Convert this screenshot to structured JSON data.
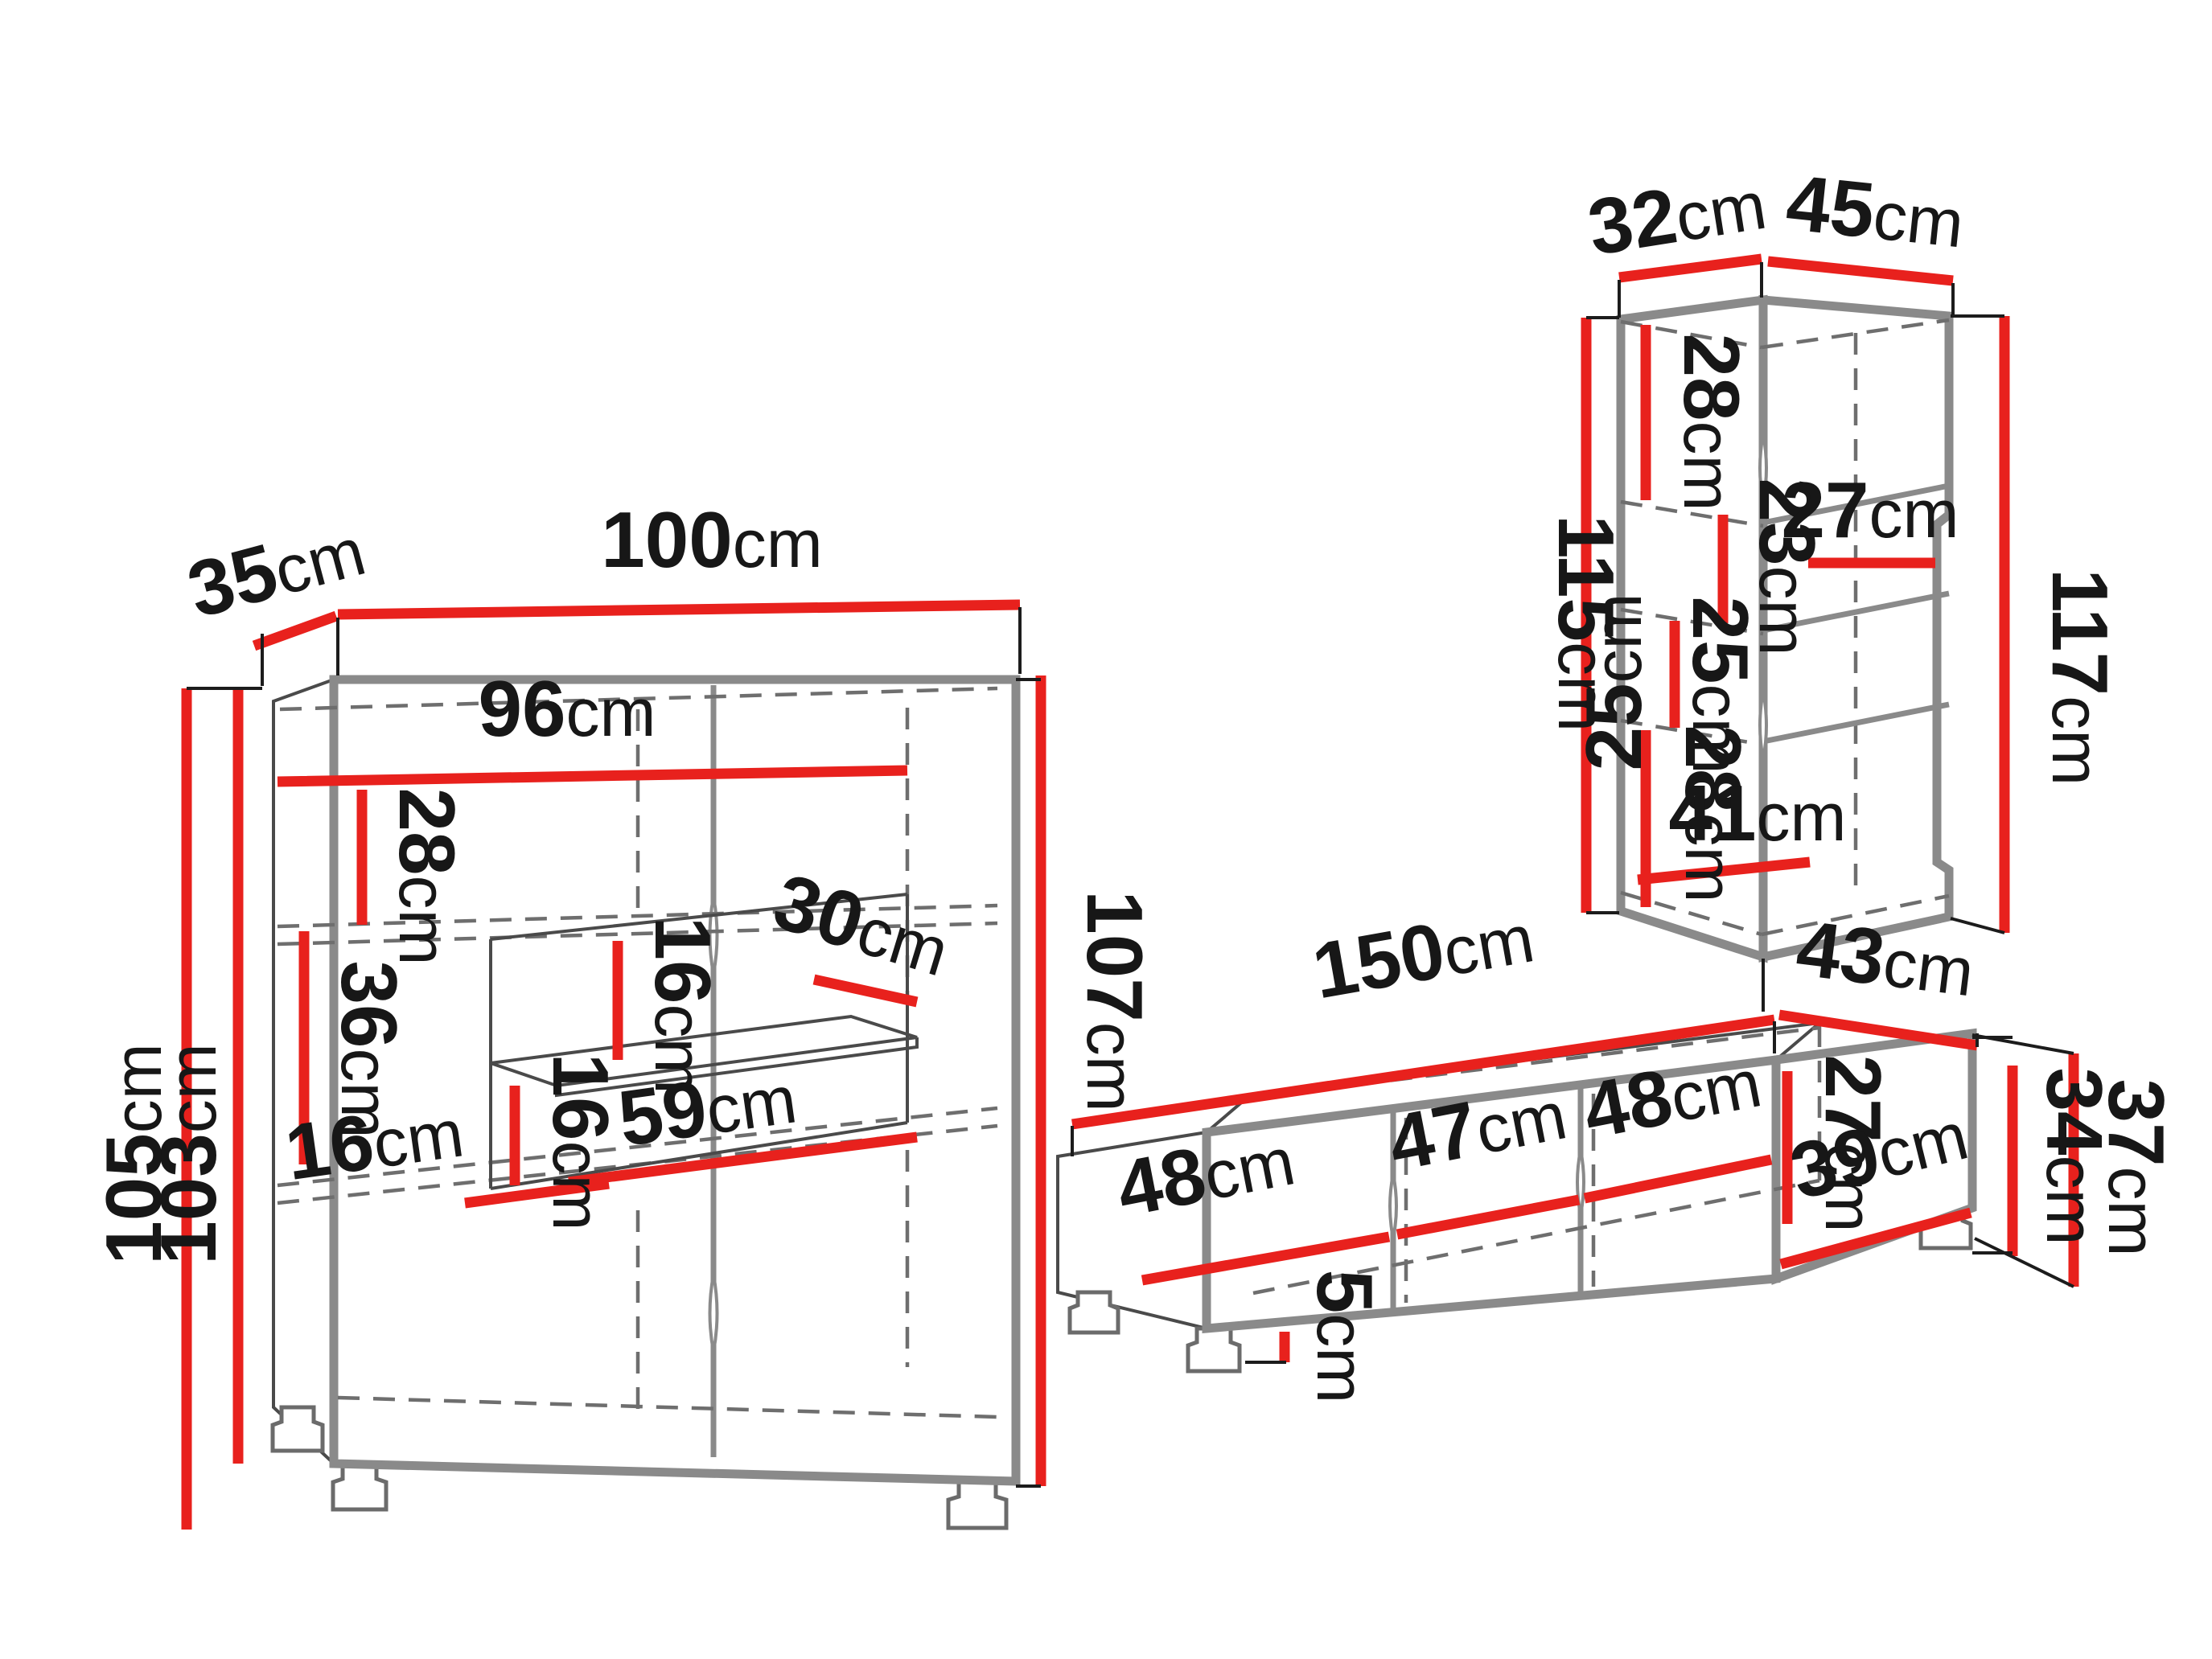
{
  "diagram_title": "furniture-set-dimension-diagram",
  "unit": "cm",
  "colors": {
    "dimension_red": "#e8211d",
    "carcass_gray": "#8a8a8a",
    "label_black": "#171717",
    "background": "#ffffff"
  },
  "highboard": {
    "depth_top": {
      "n": "35",
      "u": "cm"
    },
    "width_top": {
      "n": "100",
      "u": "cm"
    },
    "inner_width": {
      "n": "96",
      "u": "cm"
    },
    "top_section": {
      "n": "28",
      "u": "cm"
    },
    "mid_section": {
      "n": "36",
      "u": "cm"
    },
    "gap_upper": {
      "n": "16",
      "u": "cm"
    },
    "gap_lower": {
      "n": "16",
      "u": "cm"
    },
    "niche_offset": {
      "n": "16",
      "u": "cm"
    },
    "glass_depth": {
      "n": "30",
      "u": "cm"
    },
    "niche_width": {
      "n": "59",
      "u": "cm"
    },
    "height_carcass": {
      "n": "103",
      "u": "cm"
    },
    "height_total": {
      "n": "105",
      "u": "cm"
    },
    "height_right": {
      "n": "107",
      "u": "cm"
    }
  },
  "wall_cabinet": {
    "depth_left": {
      "n": "32",
      "u": "cm"
    },
    "width_right": {
      "n": "45",
      "u": "cm"
    },
    "height_left": {
      "n": "115",
      "u": "cm"
    },
    "height_right": {
      "n": "117",
      "u": "cm"
    },
    "section_1": {
      "n": "28",
      "u": "cm"
    },
    "section_2": {
      "n": "23",
      "u": "cm"
    },
    "shelf_width": {
      "n": "27",
      "u": "cm"
    },
    "section_3a": {
      "n": "25",
      "u": "cm"
    },
    "section_3b": {
      "n": "25",
      "u": "cm"
    },
    "section_4": {
      "n": "28",
      "u": "cm"
    },
    "bottom_width": {
      "n": "41",
      "u": "cm"
    }
  },
  "tv_stand": {
    "width_top": {
      "n": "150",
      "u": "cm"
    },
    "depth_top": {
      "n": "43",
      "u": "cm"
    },
    "bay_left": {
      "n": "48",
      "u": "cm"
    },
    "bay_middle": {
      "n": "47",
      "u": "cm"
    },
    "bay_right": {
      "n": "48",
      "u": "cm"
    },
    "inner_height": {
      "n": "27",
      "u": "cm"
    },
    "inner_depth": {
      "n": "39",
      "u": "cm"
    },
    "height_carcass": {
      "n": "34",
      "u": "cm"
    },
    "height_total": {
      "n": "37",
      "u": "cm"
    },
    "leg_height": {
      "n": "5",
      "u": "cm"
    }
  }
}
